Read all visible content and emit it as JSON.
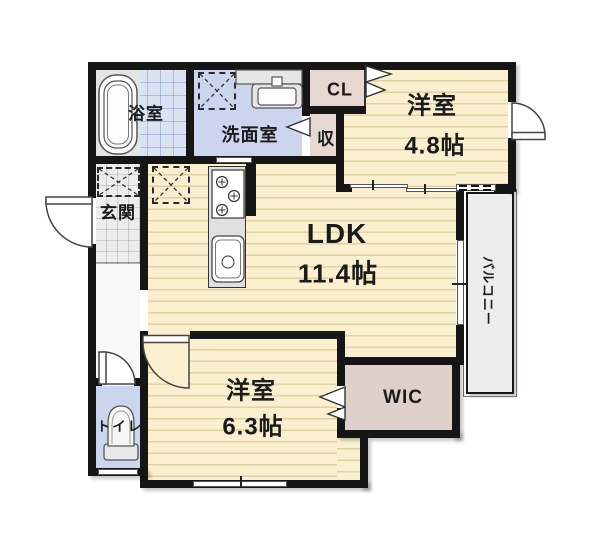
{
  "plan_type": "floor-plan",
  "rooms": {
    "bath": {
      "label": "浴室"
    },
    "washroom": {
      "label": "洗面室"
    },
    "cl": {
      "label": "CL"
    },
    "storage": {
      "label": "収"
    },
    "bedroom1": {
      "label": "洋室",
      "size": "4.8帖"
    },
    "entrance": {
      "label": "玄関"
    },
    "ldk": {
      "label": "LDK",
      "size": "11.4帖"
    },
    "balcony": {
      "label": "バルコニー"
    },
    "bedroom2": {
      "label": "洋室",
      "size": "6.3帖"
    },
    "wic": {
      "label": "WIC"
    },
    "toilet": {
      "label": "トイレ"
    }
  },
  "icons": {
    "bathtub": "nested rounded rectangles",
    "vanity_sink": "counter with basin",
    "washing_machine_space": "dashed square with X",
    "refrigerator_space": "dashed square with X",
    "shoe_storage_space": "dashed square with X",
    "kitchen_stove": "three burner circles",
    "kitchen_sink": "rounded basin with drain",
    "toilet_fixture": "bowl with tank",
    "door_swing": "quarter-circle arc",
    "sliding_window": "double thin line"
  },
  "colors": {
    "wall": "#161616",
    "wood_floor": "#faf0d0",
    "wet_area_floor": "#cbd5ee",
    "bath_tile": "#d9e3f1",
    "closet_floor": "#e6d8d0",
    "balcony_floor": "#ededed",
    "entrance_tile": "#ededed",
    "background": "#ffffff"
  }
}
